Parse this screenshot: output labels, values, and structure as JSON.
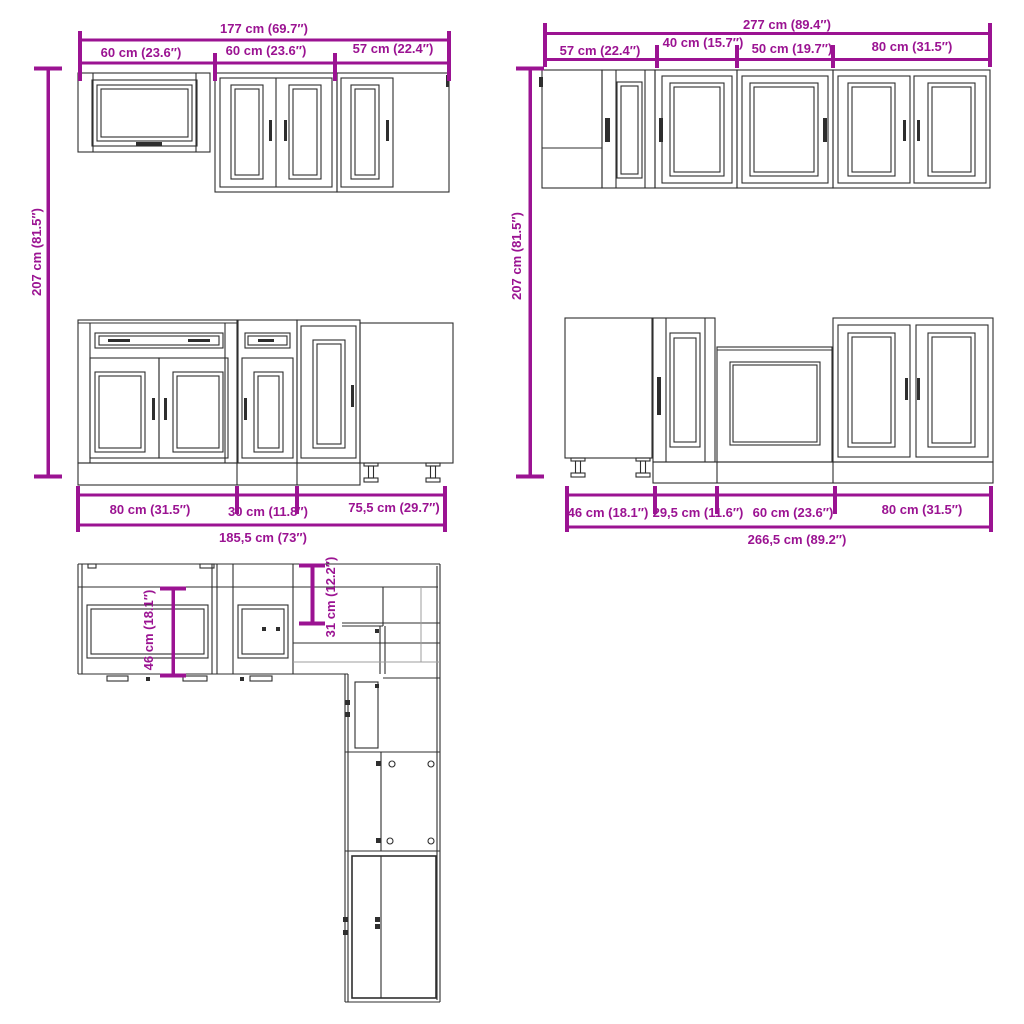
{
  "diagram_title": "kitchen cabinet set dimension diagram",
  "colors": {
    "dimension": "#9B1392",
    "line": "#2E2E2E",
    "gray": "#9C9C9C",
    "background": "#FFFFFF"
  },
  "wall_run_left": {
    "total": "177 cm (69.7″)",
    "segments": [
      "60 cm (23.6″)",
      "60 cm (23.6″)",
      "57 cm (22.4″)"
    ]
  },
  "wall_run_right": {
    "total": "277 cm (89.4″)",
    "segments": [
      "57 cm (22.4″)",
      "40 cm (15.7″)",
      "50 cm (19.7″)",
      "80 cm (31.5″)"
    ]
  },
  "height_left": "207 cm (81.5″)",
  "height_right": "207 cm (81.5″)",
  "base_run_left": {
    "segments": [
      "80 cm (31.5″)",
      "30 cm (11.8″)",
      "75,5 cm (29.7″)"
    ],
    "total": "185,5 cm (73″)"
  },
  "base_run_right": {
    "segments": [
      "46 cm (18.1″)",
      "29,5 cm (11.6″)",
      "60 cm (23.6″)",
      "80 cm (31.5″)"
    ],
    "total": "266,5 cm (89.2″)"
  },
  "floor_plan": {
    "base_depth": "46 cm (18.1″)",
    "wall_depth": "31 cm (12.2″)"
  }
}
